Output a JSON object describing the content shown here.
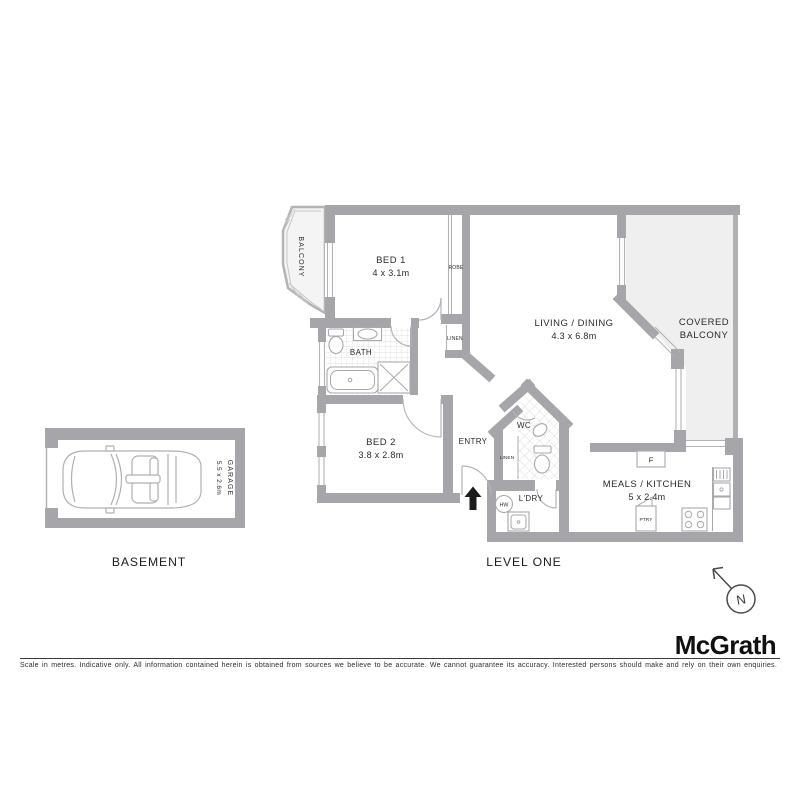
{
  "labels": {
    "basement": "BASEMENT",
    "level_one": "LEVEL ONE",
    "balcony": "BALCONY",
    "covered_line1": "COVERED",
    "covered_line2": "BALCONY",
    "bath": "BATH",
    "wc": "WC",
    "entry": "ENTRY",
    "laundry": "L'DRY",
    "hot_water": "HW",
    "robe": "ROBE",
    "linen": "LINEN",
    "fridge": "F",
    "pantry": "PTRY"
  },
  "rooms": {
    "bed1": {
      "name": "BED 1",
      "dims": "4 x 3.1m"
    },
    "bed2": {
      "name": "BED 2",
      "dims": "3.8 x 2.8m"
    },
    "living": {
      "name": "LIVING / DINING",
      "dims": "4.3 x 6.8m"
    },
    "meals": {
      "name": "MEALS / KITCHEN",
      "dims": "5 x 2.4m"
    },
    "garage": {
      "name": "GARAGE",
      "dims": "5.5 x 2.6m"
    }
  },
  "compass": {
    "north": "N"
  },
  "brand": {
    "logo": "McGrath"
  },
  "footer": {
    "disclaimer": "Scale in metres. Indicative only. All information contained herein is obtained from sources we believe to be accurate. We cannot guarantee its accuracy. Interested persons should make and rely on their own enquiries."
  },
  "colors": {
    "wall": "#a6a6aa",
    "light_area": "#eeefee",
    "text": "#2b2b2b",
    "accent_black": "#1a1a1a"
  }
}
